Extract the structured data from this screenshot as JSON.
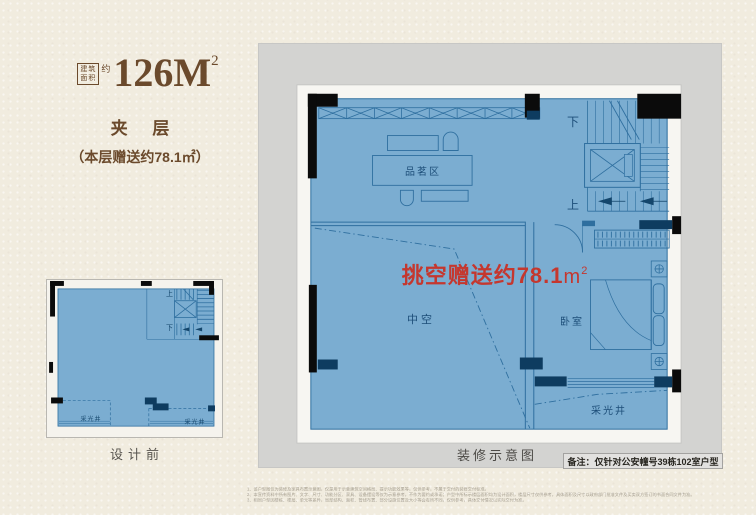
{
  "colors": {
    "background": "#f1ecdf",
    "panel_gray": "#d3d3d1",
    "plan_fill_blue": "#7badd1",
    "plan_line_blue": "#2f6f9f",
    "wall_black": "#0b0b0b",
    "wall_navy": "#0e3c60",
    "accent_red": "#c5372e",
    "title_brown": "#6b4a2c",
    "room_label_blue": "#1d4e79"
  },
  "title": {
    "box_line1": "建筑",
    "box_line2": "面积",
    "approx": "约",
    "number": "126M",
    "sup": "2"
  },
  "left_column": {
    "floor_label": "夹 层",
    "bonus_note": "（本层赠送约78.1㎡）",
    "small_plan": {
      "caption": "设计前",
      "up": "上",
      "down": "下",
      "light_well_left": "采光井",
      "light_well_right": "采光井"
    }
  },
  "main_plan": {
    "caption": "装修示意图",
    "note": "备注：仅针对公安幢号39栋102室户型",
    "highlight": {
      "text": "挑空赠送约78.1",
      "unit": "m",
      "sup": "2"
    },
    "labels": {
      "tea_area": "品茗区",
      "down": "下",
      "up": "上",
      "void": "中空",
      "bedroom": "卧室",
      "light_well": "采光井"
    }
  },
  "disclaimer": {
    "lines": [
      "1、该户型图仅为装修及家具布置示意图，仅是用于示意建筑空间格局、提示功能效果等，仅供参考，不属于交付的装修交付标准。",
      "2、本宣传资料中所有图片、文字、尺寸、功能分区、家具、设备摆设等仅为示意参考，不作为要约或承诺；户型中所标示楼层面积均为设计面积，楼层尺寸仅供参考，具体面积及尺寸以政府部门批准文件及买卖双方签订的书面合同文件为准。",
      "3、相同户型因楼栋、楼层、单元等差异，局部结构、面积、管线布置、部分设施位置及大小等会有所不同，仅供参考，具体交付情况以实际交付为准。"
    ]
  }
}
